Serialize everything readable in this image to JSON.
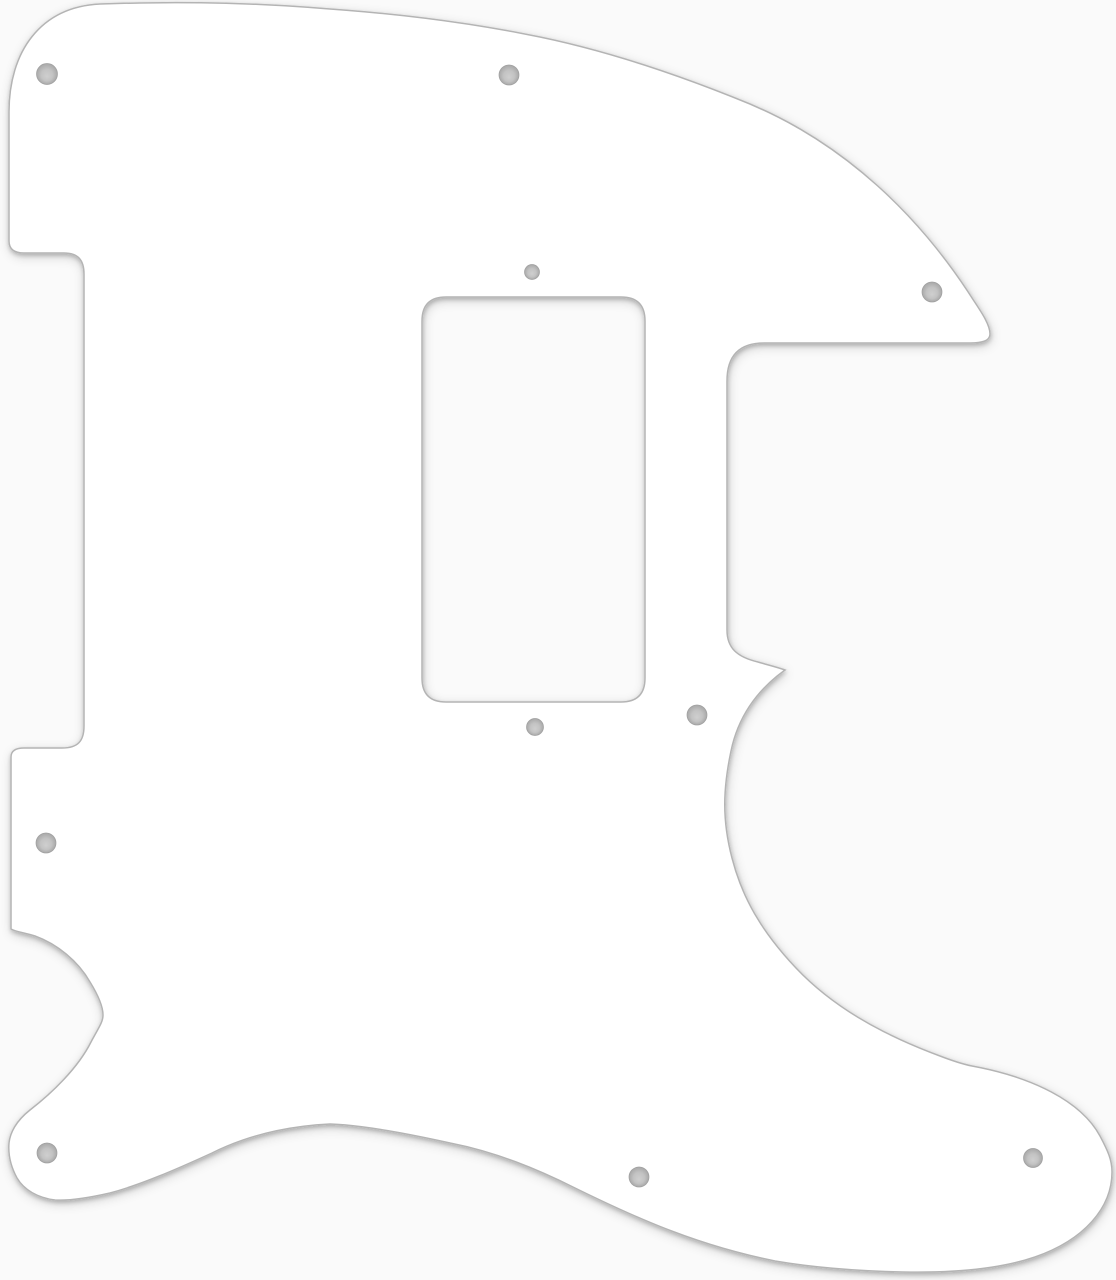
{
  "scene": {
    "description": "White single-ply Telecaster-style electric guitar pickguard with a rectangular humbucker pickup cutout and ten countersunk screw holes, shown flat on a plain light background",
    "canvas": {
      "width": 1116,
      "height": 1280
    },
    "colors": {
      "background": "#fafafa",
      "pickguard_fill": "#ffffff",
      "outline": "#b4b4b4",
      "shadow": "#000000",
      "hole_center": "#cfcfcf",
      "hole_mid": "#c3c3c3",
      "hole_rim": "#a8a8a8",
      "hole_stroke": "#9f9f9f"
    },
    "outline_width": 1.5,
    "shadow_layers": [
      {
        "dx": 0.5,
        "dy": 2,
        "blur": 2,
        "opacity": 0.2
      },
      {
        "dx": 1,
        "dy": 3,
        "blur": 5,
        "opacity": 0.16
      }
    ],
    "pickguard_path": "M 100 4 C 180 1 260 3 330 9 C 400 14 472 23 540 37 C 612 52 682 76 750 104 C 845 144 920 216 974 301 C 982 313 990 325 990 334 C 990 341 982 343 970 343 L 764 343 C 742 343 727 353 727 381 L 727 630 C 727 648 737 657 758 662 C 768 665 777 667 785 670 C 760 688 739 713 731 751 C 723 789 722 820 732 858 C 742 897 761 931 796 968 C 831 1005 878 1033 940 1056 C 953 1061 962 1064 972 1066 C 1032 1077 1081 1101 1100 1136 C 1108 1151 1112 1160 1112 1172 C 1112 1208 1084 1240 1035 1257 C 1000 1269 953 1273 903 1272 C 857 1271 816 1268 775 1261 C 700 1246 640 1220 575 1188 C 537 1169 496 1152 450 1143 C 405 1133 360 1125 330 1124 C 290 1126 250 1134 212 1153 C 175 1170 140 1185 110 1193 C 88 1198 70 1201 55 1200 C 38 1198 24 1190 17 1178 C 11 1167 8 1155 9 1143 C 10 1133 16 1121 30 1110 C 52 1093 78 1068 91 1042 C 99 1027 103 1022 103 1015 C 103 1007 98 995 90 982 C 78 961 57 944 35 936 C 26 933 16 932 11 929 L 11 757 C 11 751 15 748 24 748 L 62 748 C 78 748 84 741 84 726 L 84 274 C 84 260 78 253 64 253 L 24 253 C 14 253 9 249 9 241 L 9 112 C 9 52 40 7 100 4 Z",
    "humbucker_cutout_path": "M 446 297 L 621 297 C 637 297 645 305 645 321 L 645 678 C 645 694 637 702 621 702 L 446 702 C 430 702 422 694 422 678 L 422 321 C 422 305 430 297 446 297 Z",
    "screw_holes": [
      {
        "cx": 47,
        "cy": 74,
        "r": 10.5
      },
      {
        "cx": 509,
        "cy": 75,
        "r": 10
      },
      {
        "cx": 932,
        "cy": 292,
        "r": 10
      },
      {
        "cx": 532,
        "cy": 272,
        "r": 7.5
      },
      {
        "cx": 535,
        "cy": 727,
        "r": 8.5
      },
      {
        "cx": 697,
        "cy": 715,
        "r": 10
      },
      {
        "cx": 46,
        "cy": 843,
        "r": 10
      },
      {
        "cx": 47,
        "cy": 1153,
        "r": 10
      },
      {
        "cx": 639,
        "cy": 1177,
        "r": 10
      },
      {
        "cx": 1033,
        "cy": 1158,
        "r": 9.5
      }
    ]
  }
}
